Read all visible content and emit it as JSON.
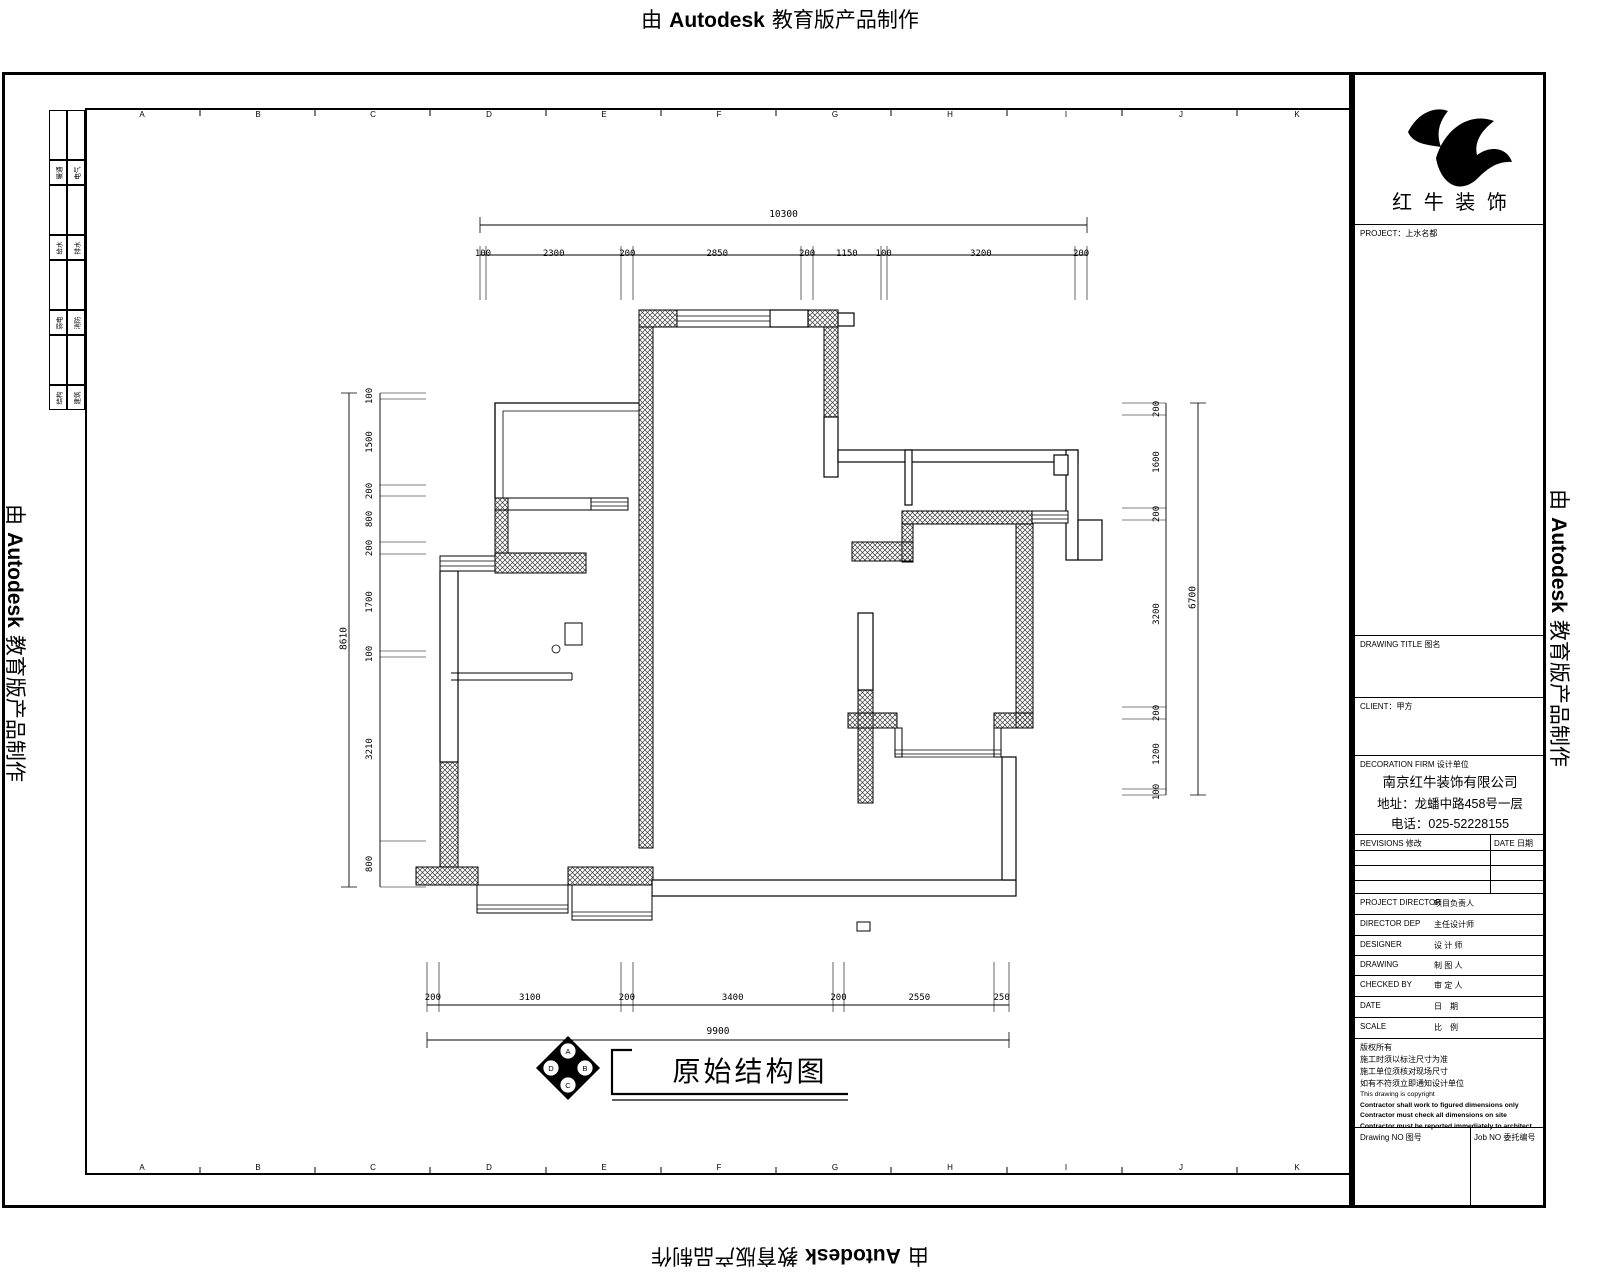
{
  "watermark": {
    "prefix": "由",
    "brand": "Autodesk",
    "suffix": "教育版产品制作"
  },
  "sheet": {
    "ruler_letters": [
      "A",
      "B",
      "C",
      "D",
      "E",
      "F",
      "G",
      "H",
      "I",
      "J",
      "K"
    ]
  },
  "sign_strip": {
    "rows": [
      {
        "c1": "暖通",
        "c2": "电气"
      },
      {
        "c1": "给水",
        "c2": "排水"
      },
      {
        "c1": "弱电",
        "c2": "消防"
      },
      {
        "c1": "结构",
        "c2": "建筑"
      }
    ]
  },
  "plan_dims": {
    "top": {
      "total": "10300",
      "segments": [
        "100",
        "2300",
        "200",
        "2850",
        "200",
        "1150",
        "100",
        "3200",
        "200"
      ]
    },
    "bottom": {
      "total": "9900",
      "segments": [
        "200",
        "3100",
        "200",
        "3400",
        "200",
        "2550",
        "250"
      ]
    },
    "left": {
      "total": "8610",
      "segments": [
        "100",
        "1500",
        "200",
        "800",
        "200",
        "1700",
        "100",
        "3210",
        "800"
      ]
    },
    "right": {
      "total": "6700",
      "segments": [
        "200",
        "1600",
        "200",
        "3200",
        "200",
        "1200",
        "100"
      ]
    }
  },
  "drawing_title": {
    "text": "原始结构图",
    "compass": [
      "A",
      "B",
      "C",
      "D"
    ]
  },
  "title_block": {
    "brand": "红 牛 装 饰",
    "project": "PROJECT：上水名都",
    "drawing_title_label": "DRAWING TITLE 图名",
    "client_label": "CLIENT：甲方",
    "firm_label": "DECORATION FIRM 设计单位",
    "company_name": "南京红牛装饰有限公司",
    "company_address": "地址：龙蟠中路458号一层",
    "company_phone": "电话：025-52228155",
    "revisions_label": "REVISIONS 修改",
    "date_label": "DATE 日期",
    "rows": [
      {
        "en": "PROJECT DIRECTOR",
        "zh": "项目负责人"
      },
      {
        "en": "DIRECTOR DEP",
        "zh": "主任设计师"
      },
      {
        "en": "DESIGNER",
        "zh": "设 计 师"
      },
      {
        "en": "DRAWING",
        "zh": "制 图 人"
      },
      {
        "en": "CHECKED BY",
        "zh": "审 定 人"
      },
      {
        "en": "DATE",
        "zh": "日　期"
      },
      {
        "en": "SCALE",
        "zh": "比　例"
      }
    ],
    "notes_zh": [
      "版权所有",
      "施工时须以标注尺寸为准",
      "施工单位须核对现场尺寸",
      "如有不符须立即通知设计单位"
    ],
    "notes_en": [
      "This drawing is copyright",
      "Contractor shall work to figured dimensions only",
      "Contractor must check all dimensions on site",
      "Contractor must be reported immediately to architect"
    ],
    "drawing_no_label": "Drawing NO 图号",
    "job_no_label": "Job NO 委托编号"
  }
}
